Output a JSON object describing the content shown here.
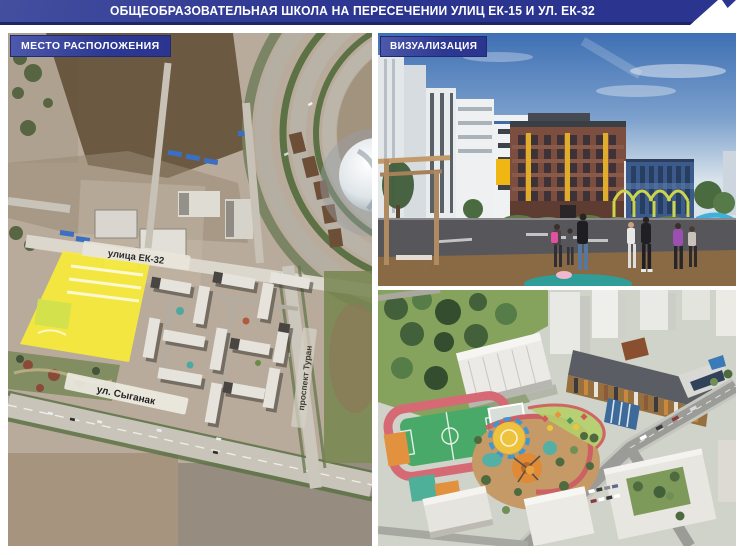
{
  "header": {
    "title": "ОБЩЕОБРАЗОВАТЕЛЬНАЯ ШКОЛА НА ПЕРЕСЕЧЕНИИ УЛИЦ ЕК-15 И УЛ. ЕК-32",
    "background_color": "#2b3590"
  },
  "panels": {
    "map": {
      "badge": "МЕСТО РАСПОЛОЖЕНИЯ",
      "streets": [
        {
          "name": "улица ЕК-32"
        },
        {
          "name": "ул. Сыганак"
        },
        {
          "name": "проспект Туран"
        }
      ],
      "site_highlight_color": "#f7ea38"
    },
    "visualization": {
      "badge": "ВИЗУАЛИЗАЦИЯ"
    }
  }
}
